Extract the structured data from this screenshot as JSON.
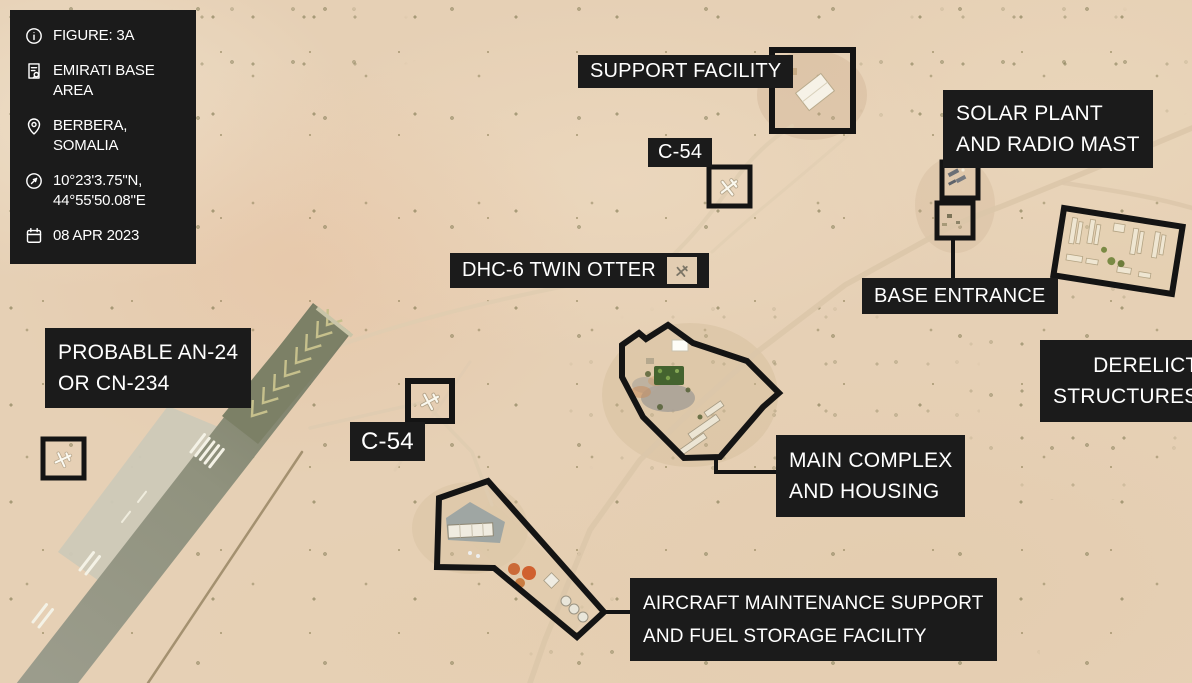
{
  "figure_info": {
    "rows": [
      {
        "icon": "info-icon",
        "text": "FIGURE: 3A"
      },
      {
        "icon": "file-search-icon",
        "text": "EMIRATI BASE AREA"
      },
      {
        "icon": "location-pin-icon",
        "text": "BERBERA, SOMALIA"
      },
      {
        "icon": "compass-icon",
        "line1": "10°23'3.75\"N,",
        "line2": "44°55'50.08\"E"
      },
      {
        "icon": "calendar-icon",
        "text": "08 APR 2023"
      }
    ]
  },
  "annotations": {
    "support_facility": {
      "text": "SUPPORT FACILITY"
    },
    "c54_north": {
      "text": "C-54"
    },
    "solar_plant": {
      "line1": "SOLAR PLANT",
      "line2": "AND RADIO MAST"
    },
    "base_entrance": {
      "text": "BASE ENTRANCE"
    },
    "derelict_structures": {
      "line1": "DERELICT",
      "line2": "STRUCTURES"
    },
    "dhc6_twin_otter": {
      "text": "DHC-6 TWIN OTTER"
    },
    "probable_aircraft": {
      "line1": "PROBABLE AN-24",
      "line2": "OR CN-234"
    },
    "c54_south": {
      "text": "C-54"
    },
    "main_complex": {
      "line1": "MAIN COMPLEX",
      "line2": "AND HOUSING"
    },
    "maintenance_fuel": {
      "line1": "AIRCRAFT MAINTENANCE SUPPORT",
      "line2": "AND FUEL STORAGE FACILITY"
    }
  },
  "colors": {
    "label_background": "#1b1b1b",
    "label_text": "#ffffff",
    "annotation_outline": "#141414",
    "desert_sand": "#e6d0b5",
    "runway_gray": "#8f917e",
    "apron_gray": "#cdc9b8"
  }
}
